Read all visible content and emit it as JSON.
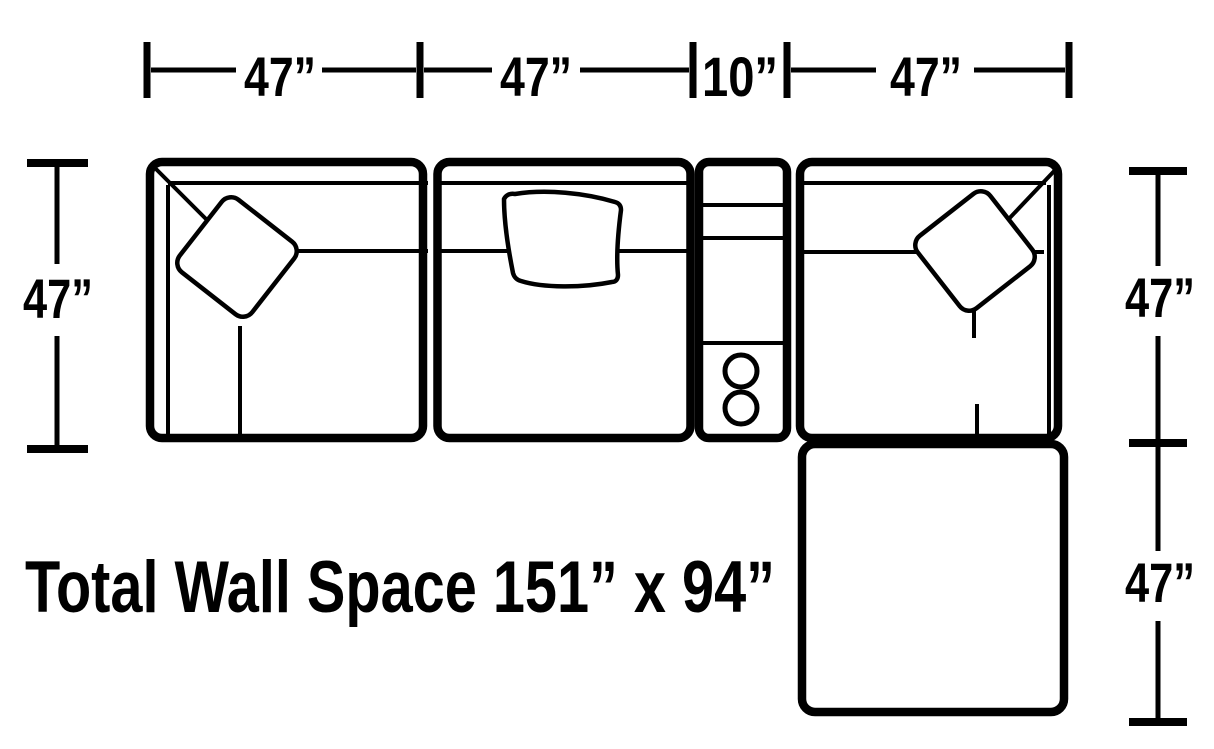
{
  "colors": {
    "line": "#000000",
    "background": "#ffffff"
  },
  "caption": {
    "text": "Total Wall Space 151” x 94”"
  },
  "dimensions": {
    "top": [
      {
        "label": "47”"
      },
      {
        "label": "47”"
      },
      {
        "label": "10”"
      },
      {
        "label": "47”"
      }
    ],
    "left": [
      {
        "label": "47”"
      }
    ],
    "right": [
      {
        "label": "47”"
      },
      {
        "label": "47”"
      }
    ]
  },
  "features": {
    "console_cup_holders": 2,
    "corner_pillows": 2,
    "back_cushions": 1
  }
}
